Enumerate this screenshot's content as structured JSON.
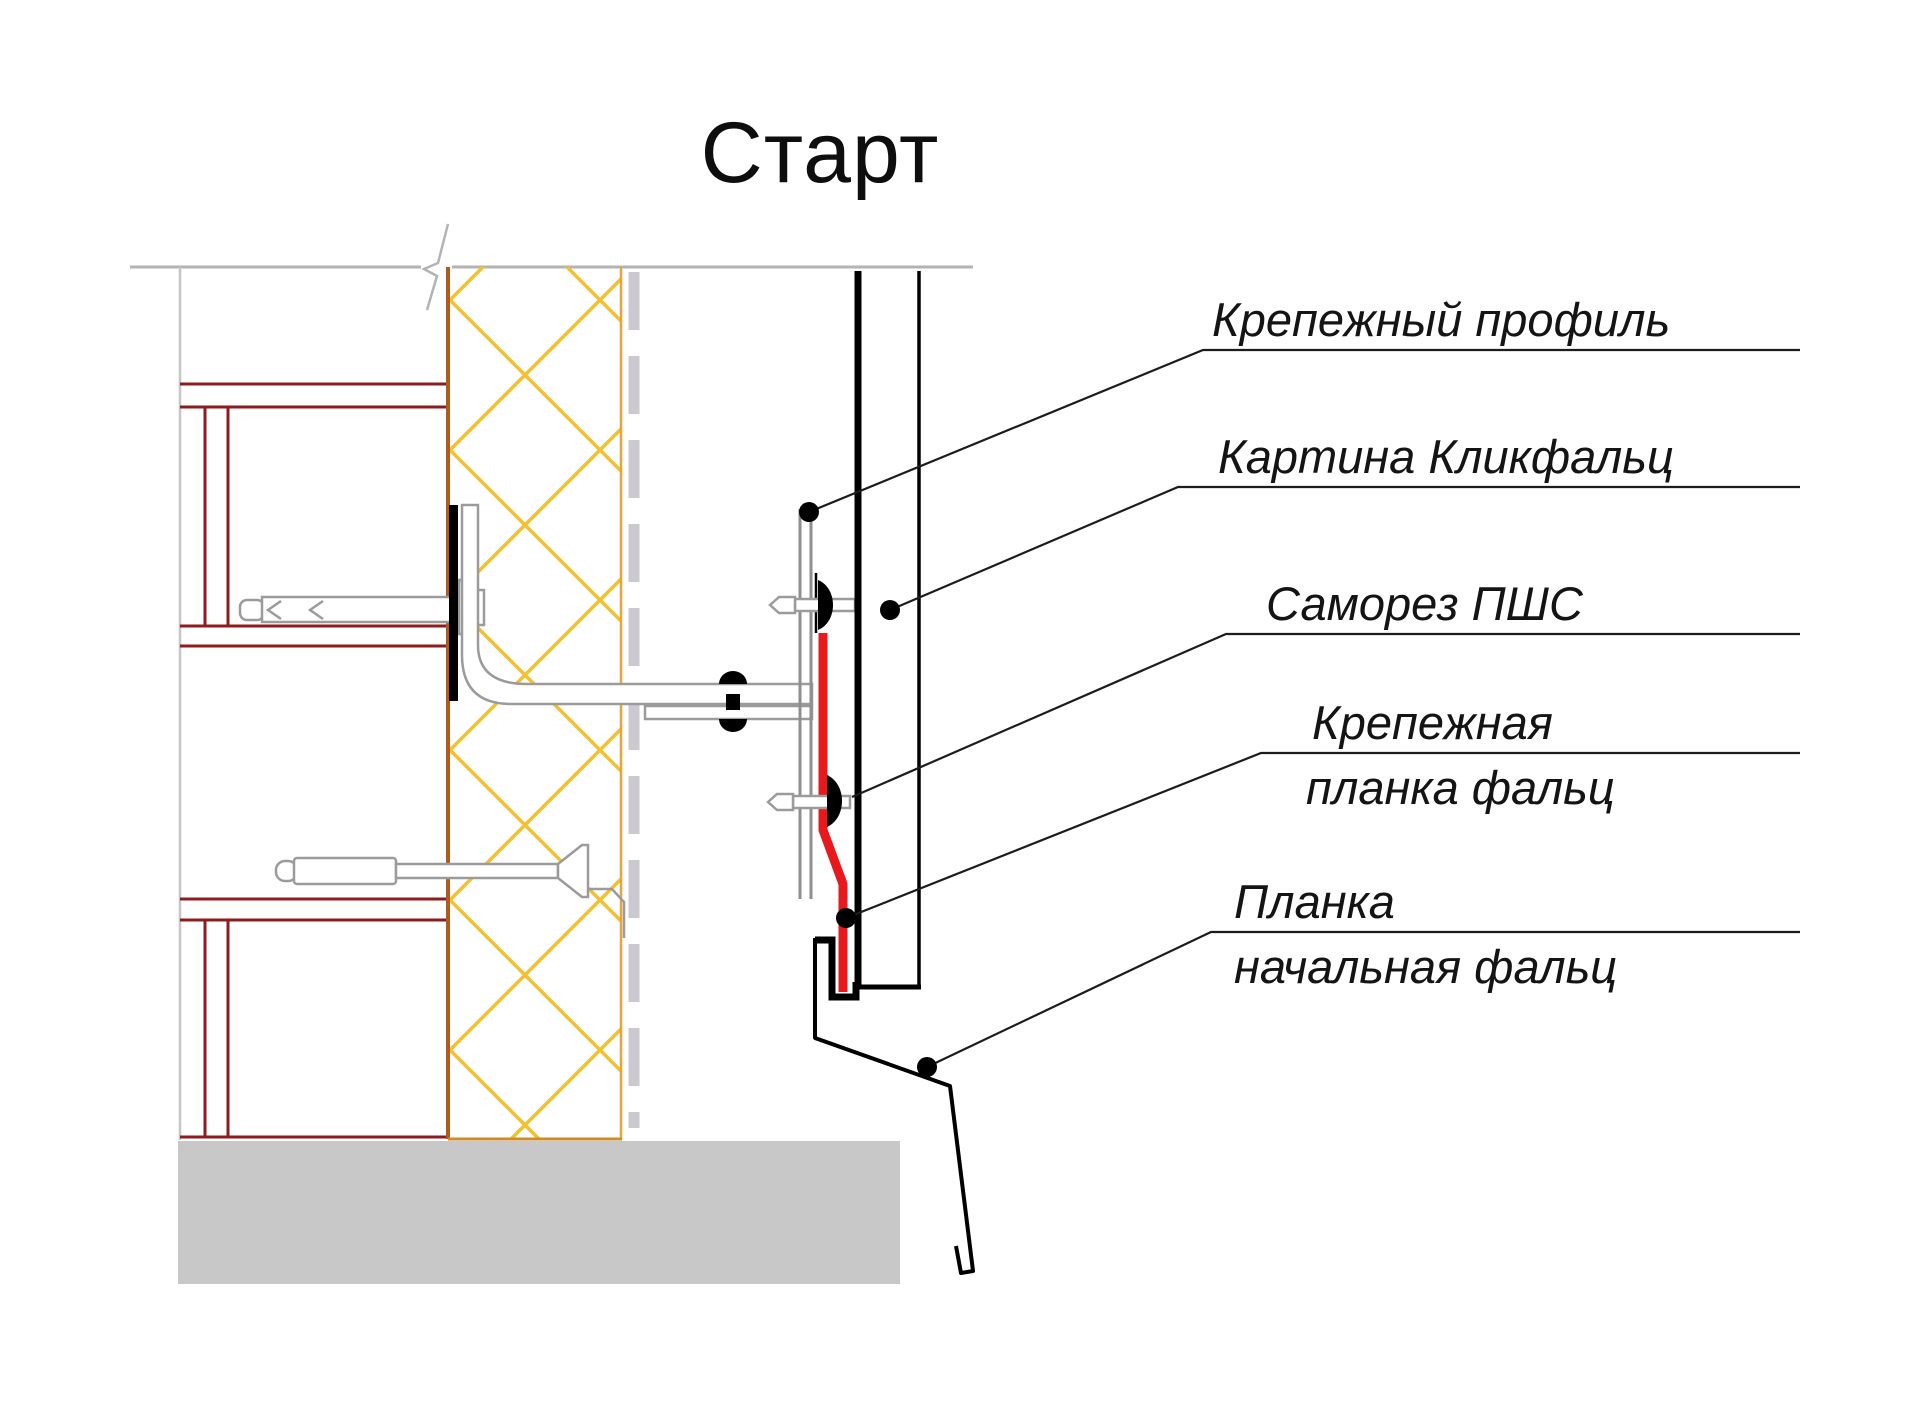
{
  "title": "Старт",
  "callouts": [
    {
      "id": "fastening-profile",
      "label": "Крепежный профиль"
    },
    {
      "id": "click-seam-panel",
      "label": "Картина Кликфальц"
    },
    {
      "id": "self-tapping-screw",
      "label": "Саморез ПШС"
    },
    {
      "id": "fastening-strip",
      "label_line1": "Крепежная",
      "label_line2": "планка фальц"
    },
    {
      "id": "starting-strip",
      "label_line1": "Планка",
      "label_line2": "начальная фальц"
    }
  ],
  "colors": {
    "frame_maroon": "#8e1b1e",
    "insulation_hatch_yellow": "#f3c02f",
    "insulation_edge_brown": "#b05a1c",
    "insulation_edge_gold": "#e8a33d",
    "membrane_gray": "#cbc8d0",
    "drawing_gray": "#9b9b9b",
    "light_gray_line": "#c6c6c6",
    "fastening_strip_red": "#e8191c",
    "foundation_gray": "#c8c8c8",
    "ink_black": "#000000"
  }
}
